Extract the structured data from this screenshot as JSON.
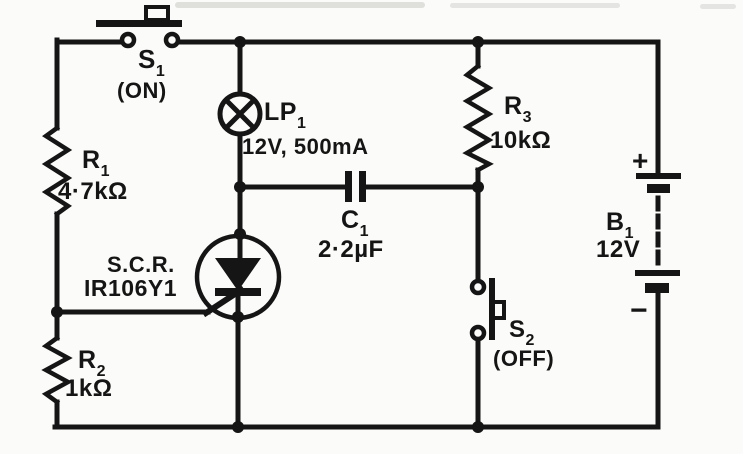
{
  "diagram": {
    "kind": "circuit-schematic",
    "description": "SCR latching lamp circuit",
    "colors": {
      "ink": "#151515",
      "paper": "#fbfbf9"
    }
  },
  "components": {
    "s1": {
      "ref": "S",
      "sub": "1",
      "state": "(ON)"
    },
    "r1": {
      "ref": "R",
      "sub": "1",
      "value": "4·7kΩ"
    },
    "lp1": {
      "ref": "LP",
      "sub": "1",
      "value": "12V, 500mA"
    },
    "c1": {
      "ref": "C",
      "sub": "1",
      "value": "2·2µF"
    },
    "r3": {
      "ref": "R",
      "sub": "3",
      "value": "10kΩ"
    },
    "scr": {
      "type_label": "S.C.R.",
      "part_number": "IR106Y1"
    },
    "r2": {
      "ref": "R",
      "sub": "2",
      "value": "1kΩ"
    },
    "s2": {
      "ref": "S",
      "sub": "2",
      "state": "(OFF)"
    },
    "b1": {
      "ref": "B",
      "sub": "1",
      "value": "12V",
      "positive": "+",
      "negative": "−"
    }
  }
}
